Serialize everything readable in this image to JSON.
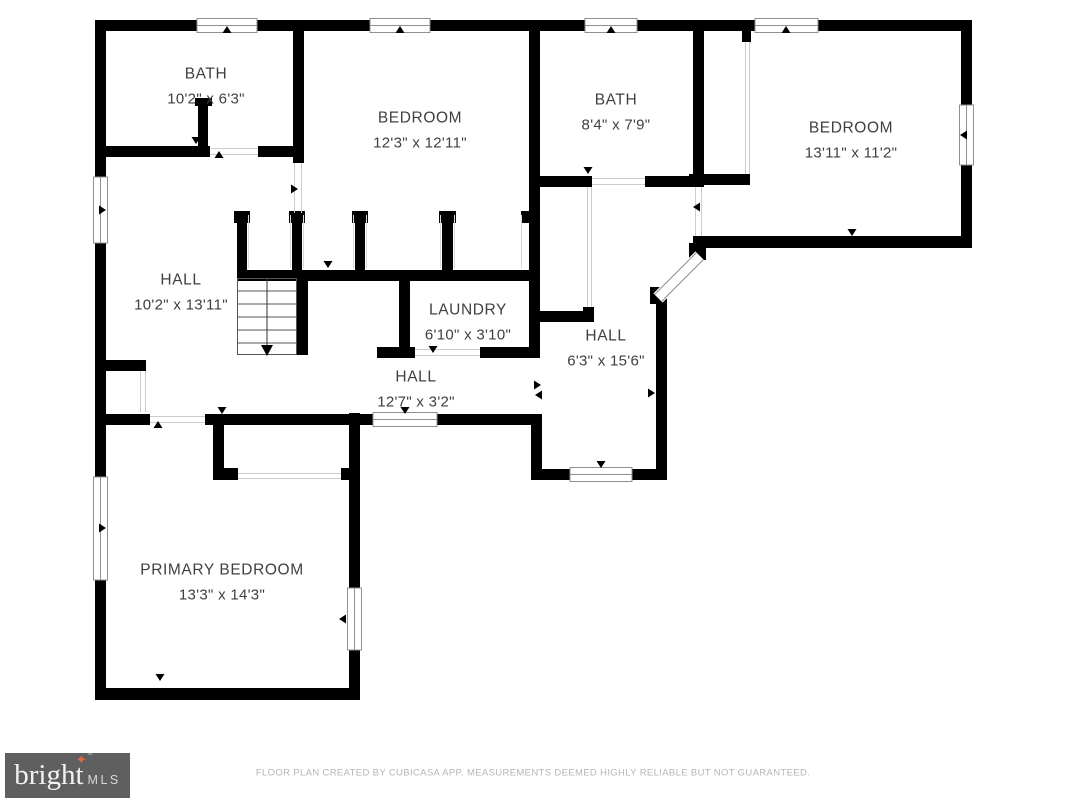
{
  "plan": {
    "rooms": [
      {
        "id": "bath-1",
        "name": "BATH",
        "dims": "10'2\" x 6'3\""
      },
      {
        "id": "bedroom-1",
        "name": "BEDROOM",
        "dims": "12'3\" x 12'11\""
      },
      {
        "id": "bath-2",
        "name": "BATH",
        "dims": "8'4\" x 7'9\""
      },
      {
        "id": "bedroom-2",
        "name": "BEDROOM",
        "dims": "13'11\" x 11'2\""
      },
      {
        "id": "hall-1",
        "name": "HALL",
        "dims": "10'2\" x 13'11\""
      },
      {
        "id": "laundry",
        "name": "LAUNDRY",
        "dims": "6'10\" x 3'10\""
      },
      {
        "id": "hall-2",
        "name": "HALL",
        "dims": "12'7\" x 3'2\""
      },
      {
        "id": "hall-3",
        "name": "HALL",
        "dims": "6'3\" x 15'6\""
      },
      {
        "id": "primary-bedroom",
        "name": "PRIMARY BEDROOM",
        "dims": "13'3\" x 14'3\""
      }
    ]
  },
  "footer": {
    "disclaimer": "FLOOR PLAN CREATED BY CUBICASA APP. MEASUREMENTS DEEMED HIGHLY RELIABLE BUT NOT GUARANTEED."
  },
  "logo": {
    "brand": "bright",
    "mls": "MLS",
    "tm": "™",
    "star_icon": "✦"
  },
  "colors": {
    "wall": "#000000",
    "room_label": "#3f3f3f",
    "disclaimer_text": "#b5b5b5",
    "logo_background": "#5f5f5f",
    "logo_star": "#e06a3f"
  }
}
